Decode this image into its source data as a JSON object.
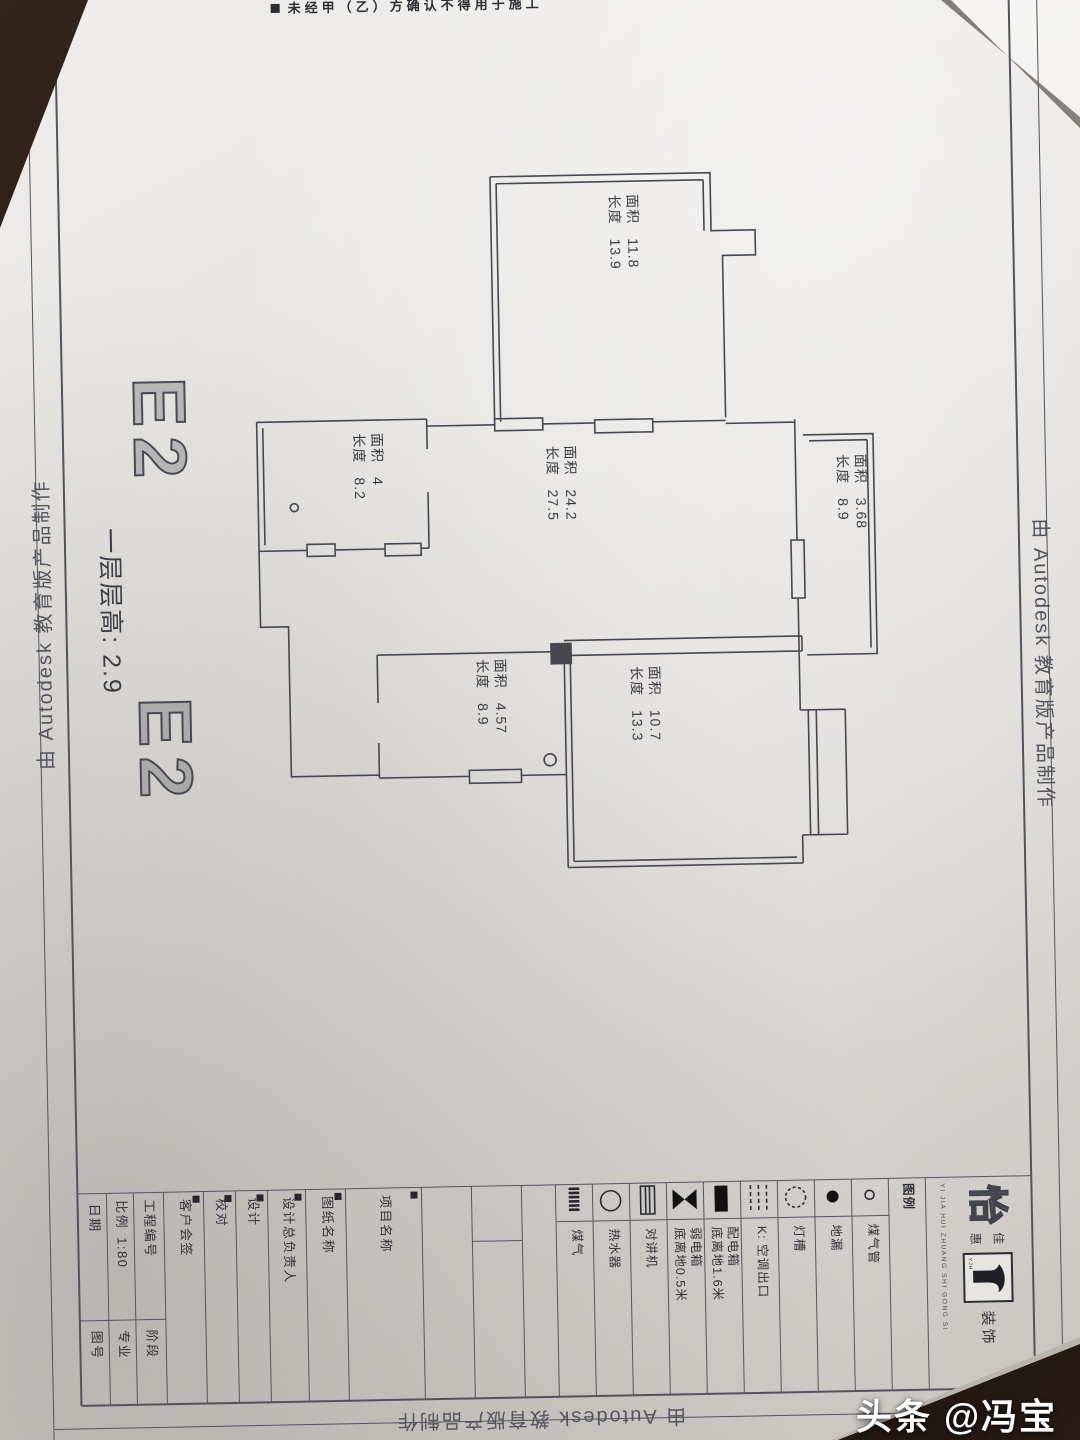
{
  "colors": {
    "paper": "#e0ddda",
    "ink": "#474750",
    "marble": "#241a14",
    "watermark": "#ffffff"
  },
  "photo": {
    "watermark": "头条 @冯宝成5"
  },
  "sheet": {
    "edge_stamp": "由 Autodesk 教育版产品制作",
    "note_top": {
      "text": "未经甲（乙）方确认不得用于施工"
    },
    "titles": {
      "e2": "E2",
      "floor_height": "一层层高: 2.9"
    },
    "room_label_area": "面积",
    "room_label_length": "长度",
    "rooms": [
      {
        "area": "11.8",
        "length": "13.9"
      },
      {
        "area": "4",
        "length": "8.2"
      },
      {
        "area": "24.2",
        "length": "27.5"
      },
      {
        "area": "3.68",
        "length": "8.9"
      },
      {
        "area": "4.57",
        "length": "8.9"
      },
      {
        "area": "10.7",
        "length": "13.3"
      }
    ],
    "legend": {
      "header": "图例",
      "items": [
        {
          "symbol": "gas-coil-icon",
          "label": "煤气"
        },
        {
          "symbol": "water-heater-icon",
          "label": "热水器"
        },
        {
          "symbol": "intercom-icon",
          "label": "对讲机"
        },
        {
          "symbol": "weak-current-box-icon",
          "label": "弱电箱",
          "note": "底离地0.5米"
        },
        {
          "symbol": "power-box-icon",
          "label": "配电箱",
          "note": "底离地1.6米"
        },
        {
          "symbol": "ac-outlet-icon",
          "label": "K: 空调出口"
        },
        {
          "symbol": "light-cove-icon",
          "label": "灯槽"
        },
        {
          "symbol": "floor-drain-icon",
          "label": "地漏"
        },
        {
          "symbol": "gas-pipe-icon",
          "label": "煤气管"
        }
      ]
    },
    "titleblock": {
      "date": {
        "label": "日期",
        "sub": "图号"
      },
      "scale": {
        "label": "比例",
        "value": "1:80",
        "sub": "专业"
      },
      "project_no": {
        "label": "工程编号",
        "sub": "阶段"
      },
      "client": {
        "label": "客户会签"
      },
      "check": {
        "label": "校对"
      },
      "design": {
        "label": "设计"
      },
      "chief": {
        "label": "设计总负责人"
      },
      "drawing_name": {
        "label": "图纸名称"
      },
      "project_name": {
        "label": "项目名称"
      }
    },
    "logo": {
      "char_main": "怡",
      "char_sub1": "佳",
      "char_sub2": "惠",
      "suffix": "装饰",
      "english": "YI JIA HUI ZHUANG SHI GONG SI",
      "mark_text": "YJH"
    }
  }
}
